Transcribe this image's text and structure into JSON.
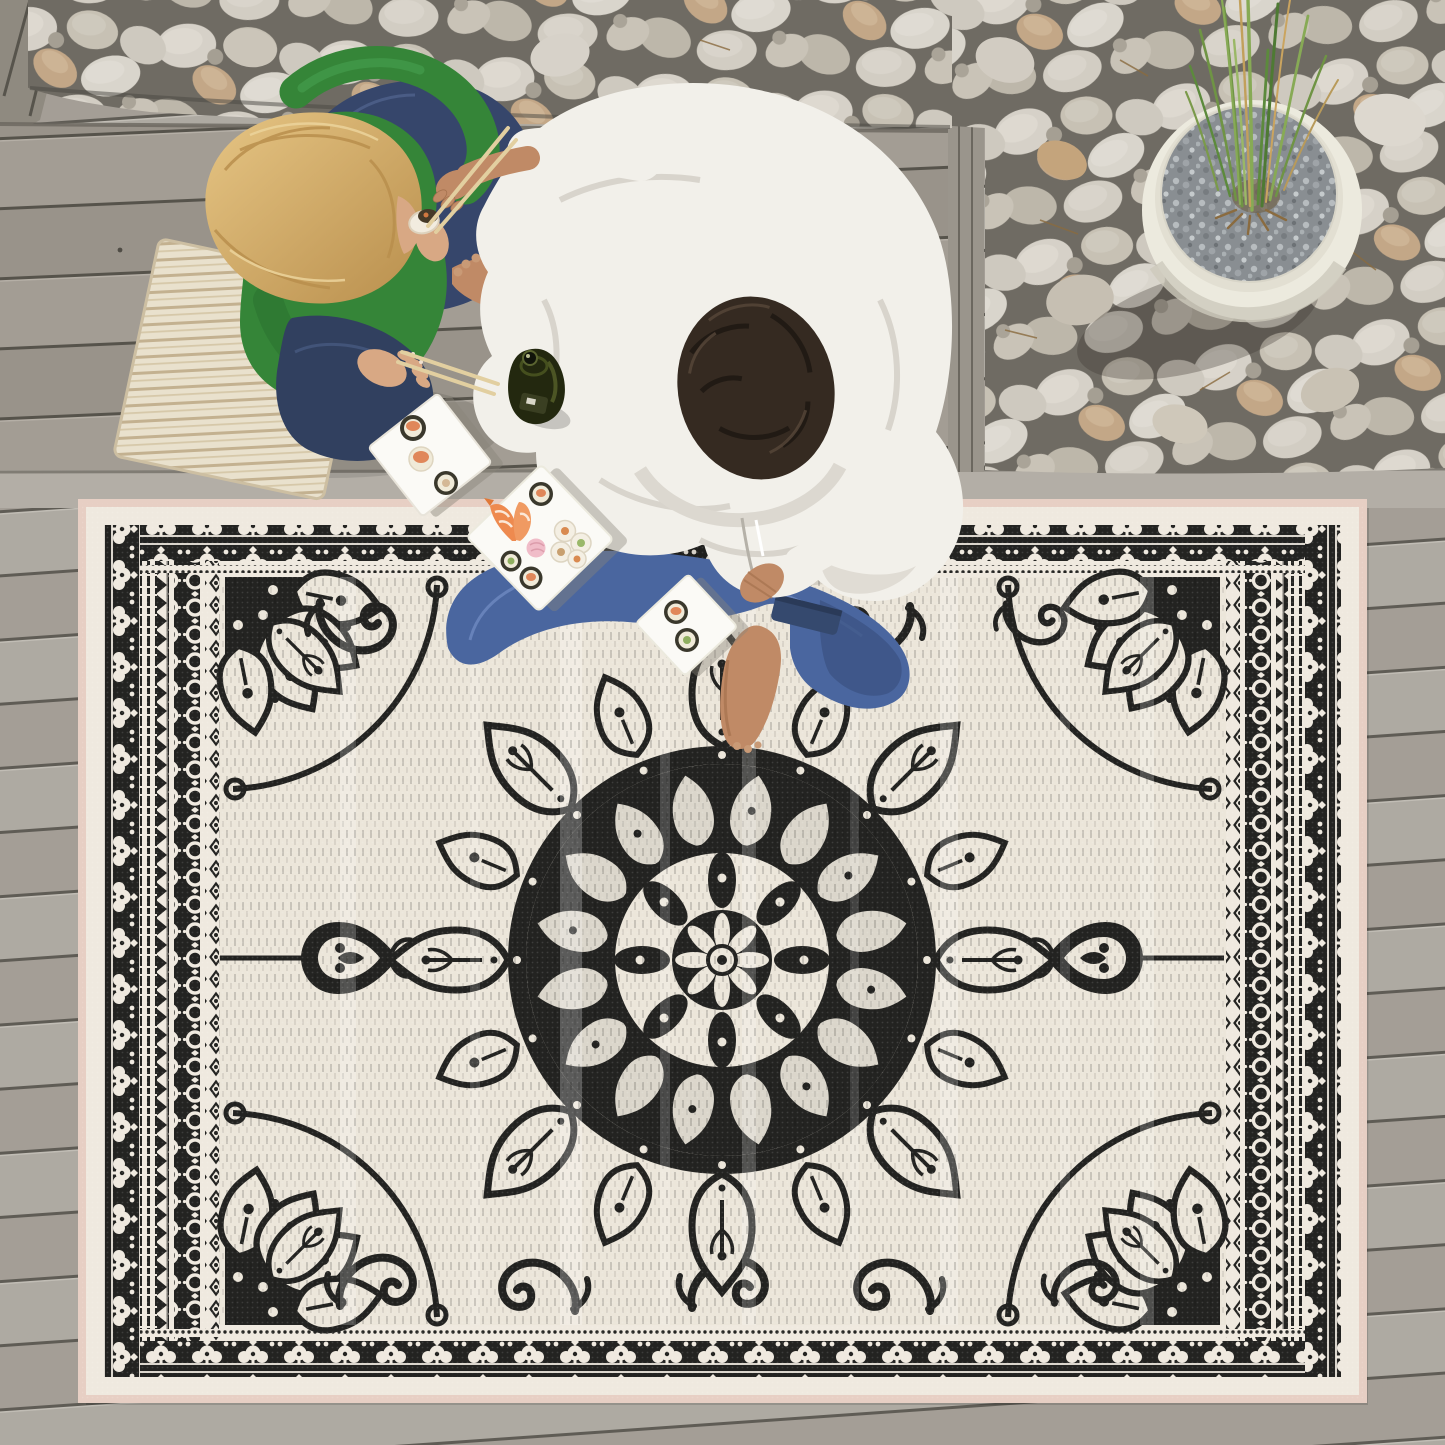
{
  "scene": {
    "aria_label": "Overhead photo of an outdoor deck: two people sitting on gray wood planks eating sushi beside a large black and white oriental medallion outdoor rug, with white river pebbles and a round white planter holding tall green grass",
    "setting": "outdoor wooden deck, top-down view",
    "regions": {
      "deck": "gray weathered wood planks, slightly slanted",
      "pebbles": "bed of smooth white and tan river pebbles along top and right",
      "bench": "wide plank seating area where the couple sits",
      "rug": "large rectangular flat-weave rug covering the lower two thirds"
    },
    "people": [
      {
        "id": "woman",
        "hair": "long blonde",
        "top": "green long-sleeve shirt",
        "pants": "dark blue jeans",
        "seat": "cream striped floor cushion",
        "holding": "sushi piece and chopsticks"
      },
      {
        "id": "man",
        "hair": "dark brown curly",
        "top": "white hooded sweatshirt",
        "pants": "blue jeans",
        "barefoot": true,
        "holding": "chopsticks reaching toward the woman"
      }
    ],
    "food": {
      "plates": 3,
      "plate_style": "square white plates set diagonally",
      "items": [
        "maki rolls with salmon",
        "maki rolls with cucumber",
        "white uramaki rolls",
        "butterflied shrimp",
        "pickled ginger"
      ],
      "drink": "dark green beer bottle",
      "utensils": "two pairs of wooden chopsticks"
    },
    "planter": {
      "shape": "round white pot",
      "contents": "gray gravel with tall green reed grass"
    },
    "rug_design": {
      "style": "oriental medallion / mandala",
      "field_color": "ivory",
      "pattern_color": "charcoal black",
      "elements": [
        "large central lotus mandala",
        "quarter medallions in each corner",
        "heart-scroll pendants on left and right axis",
        "wave scroll motifs along field edges",
        "scalloped fan border",
        "ring-chain border band",
        "zigzag and pinstripe side bands",
        "pale pink outer binding"
      ]
    }
  },
  "palette": {
    "deck_plank": "#aeaaa2",
    "deck_gap": "#5f5c55",
    "pebble_light": "#d8d3ca",
    "pebble_tan": "#c3a787",
    "rug_field": "#ece6da",
    "rug_black": "#232321",
    "rug_binding_pink": "#e7cfc4",
    "woman_top_green": "#358538",
    "woman_hair_blonde": "#cfa763",
    "man_hoodie_white": "#f2f0ea",
    "jeans_blue": "#4a669f",
    "jeans_dark": "#33425f",
    "skin_woman": "#d8a884",
    "skin_man": "#c08a66",
    "cushion_cream": "#e9e1cd",
    "plate_white": "#fbfaf6",
    "salmon": "#e0875a",
    "shrimp_orange": "#ee8a4f",
    "ginger_pink": "#f0bcc8",
    "bottle_olive": "#23280f",
    "grass_green": "#6f9444",
    "gravel_gray": "#898e92"
  }
}
